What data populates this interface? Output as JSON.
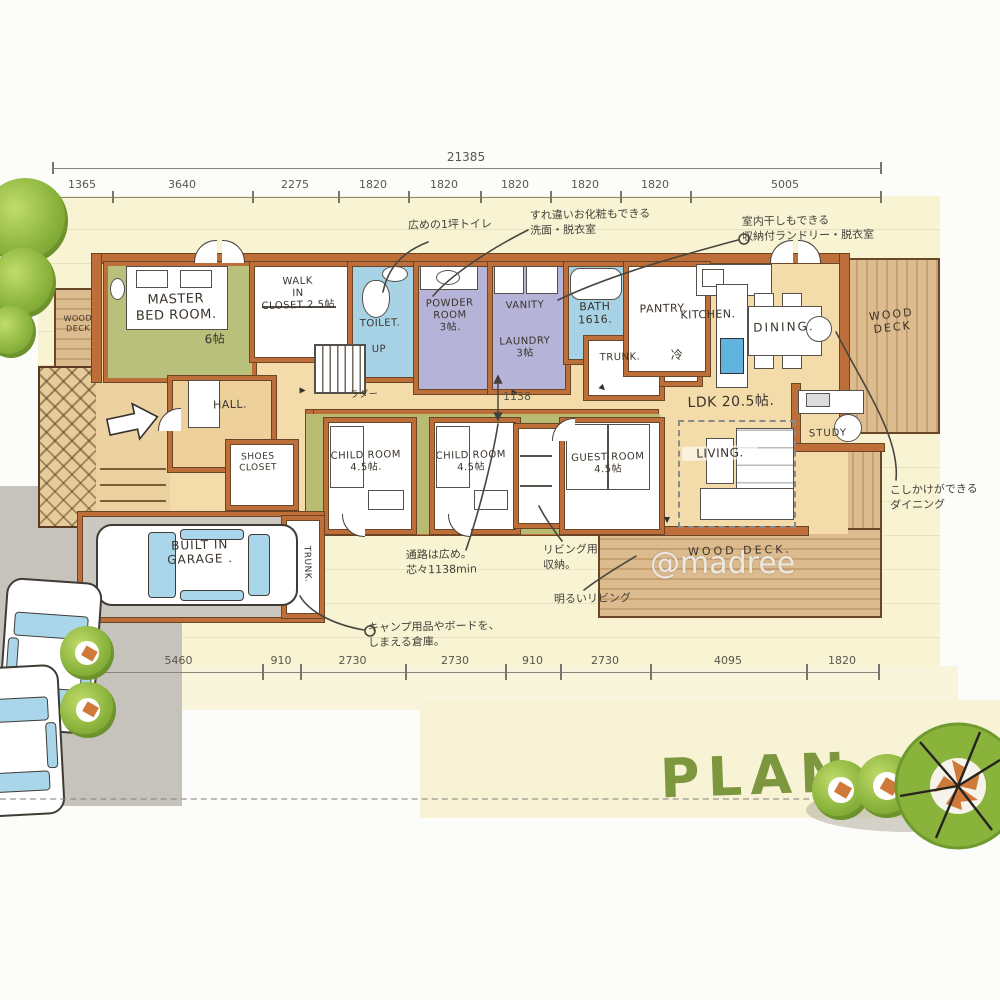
{
  "palette": {
    "wall_orange": "#bd6e39",
    "wall_outline": "#6b4626",
    "paper_yellow": "#f8f3d2",
    "interior_tan": "#f4dcaa",
    "olive_green": "#b7bc72",
    "water_blue": "#a8d3e6",
    "lavender": "#b6b3d8",
    "deck_tan": "#dcbb8e",
    "garage_gray": "#cbc8c1",
    "drive_gray": "#c6c3bc",
    "tree_green": "#8ab33c",
    "plan_green": "#7d973f"
  },
  "dims": {
    "overall": "21385",
    "top": [
      "1365",
      "3640",
      "2275",
      "1820",
      "1820",
      "1820",
      "1820",
      "1820",
      "5005"
    ],
    "bottom": [
      "5460",
      "910",
      "2730",
      "2730",
      "910",
      "2730",
      "4095",
      "1820"
    ],
    "corridor_width": "1138"
  },
  "rooms": {
    "wood_deck_west": "WOOD\nDECK",
    "master": "MASTER\nBED ROOM.",
    "master_size": "6帖",
    "wic": "WALK\nIN\nCLOSET 2.5帖",
    "toilet": "TOILET.",
    "powder": "POWDER\nROOM\n3帖.",
    "vanity": "VANITY",
    "laundry": "LAUNDRY\n3帖",
    "bath": "BATH\n1616.",
    "trunk_north": "TRUNK.",
    "fridge": "冷",
    "pantry": "PANTRY.",
    "kitchen": "KITCHEN.",
    "dining": "DINING.",
    "wood_deck_east": "WOOD\nDECK",
    "ldk": "LDK 20.5帖.",
    "living": "LIVING.",
    "study": "STUDY",
    "wood_deck_south": "WOOD DECK.",
    "hall": "HALL.",
    "shoes_closet": "SHOES\nCLOSET",
    "stairs_up": "UP",
    "stairs_ladder": "ラダー",
    "child_room_1": "CHILD ROOM\n4.5帖.",
    "child_room_2": "CHILD ROOM\n4.5帖",
    "guest_room": "GUEST ROOM\n4.5帖",
    "garage": "BUILT IN\nGARAGE .",
    "trunk_south": "TRUNK."
  },
  "annotations": {
    "toilet": "広めの1坪トイレ",
    "vanity": "すれ違いお化粧もできる\n洗面・脱衣室",
    "laundry": "室内干しもできる\n収納付ランドリー・脱衣室",
    "corridor": "通路は広め。\n芯々1138min",
    "living_storage": "リビング用\n収納。",
    "bright_living": "明るいリビング",
    "garage": "キャンプ用品やボードを、\nしまえる倉庫。",
    "dining": "こしかけができる\nダイニング"
  },
  "icons": {
    "door_marker": "▲"
  },
  "footer": {
    "plan_title": "PLAN",
    "watermark": "@madree"
  }
}
